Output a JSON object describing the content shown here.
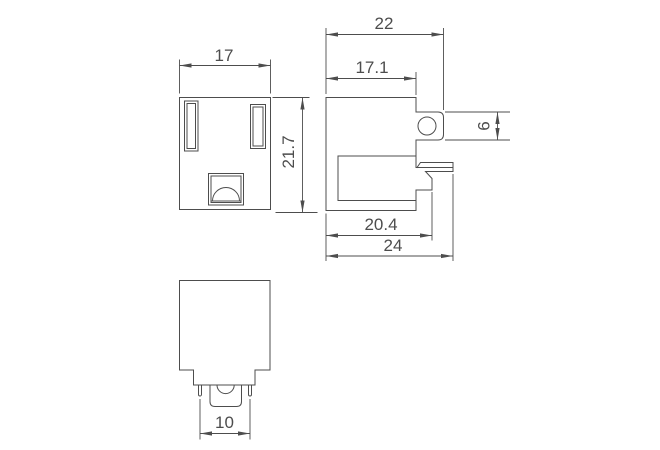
{
  "drawing": {
    "background": "#ffffff",
    "line_color": "#4d4d4d",
    "description": "three-view dimensioned outline drawing of a panel-mount power receptacle",
    "views": {
      "front": {
        "label": "front-face-view",
        "width": "17",
        "height": "21.7"
      },
      "side": {
        "label": "side-profile-view",
        "overall_width": "22",
        "body_width": "17.1",
        "tab_height": "6",
        "body_depth": "20.4",
        "overall_depth": "24"
      },
      "bottom": {
        "label": "back-view",
        "pin_spacing": "10"
      }
    }
  }
}
